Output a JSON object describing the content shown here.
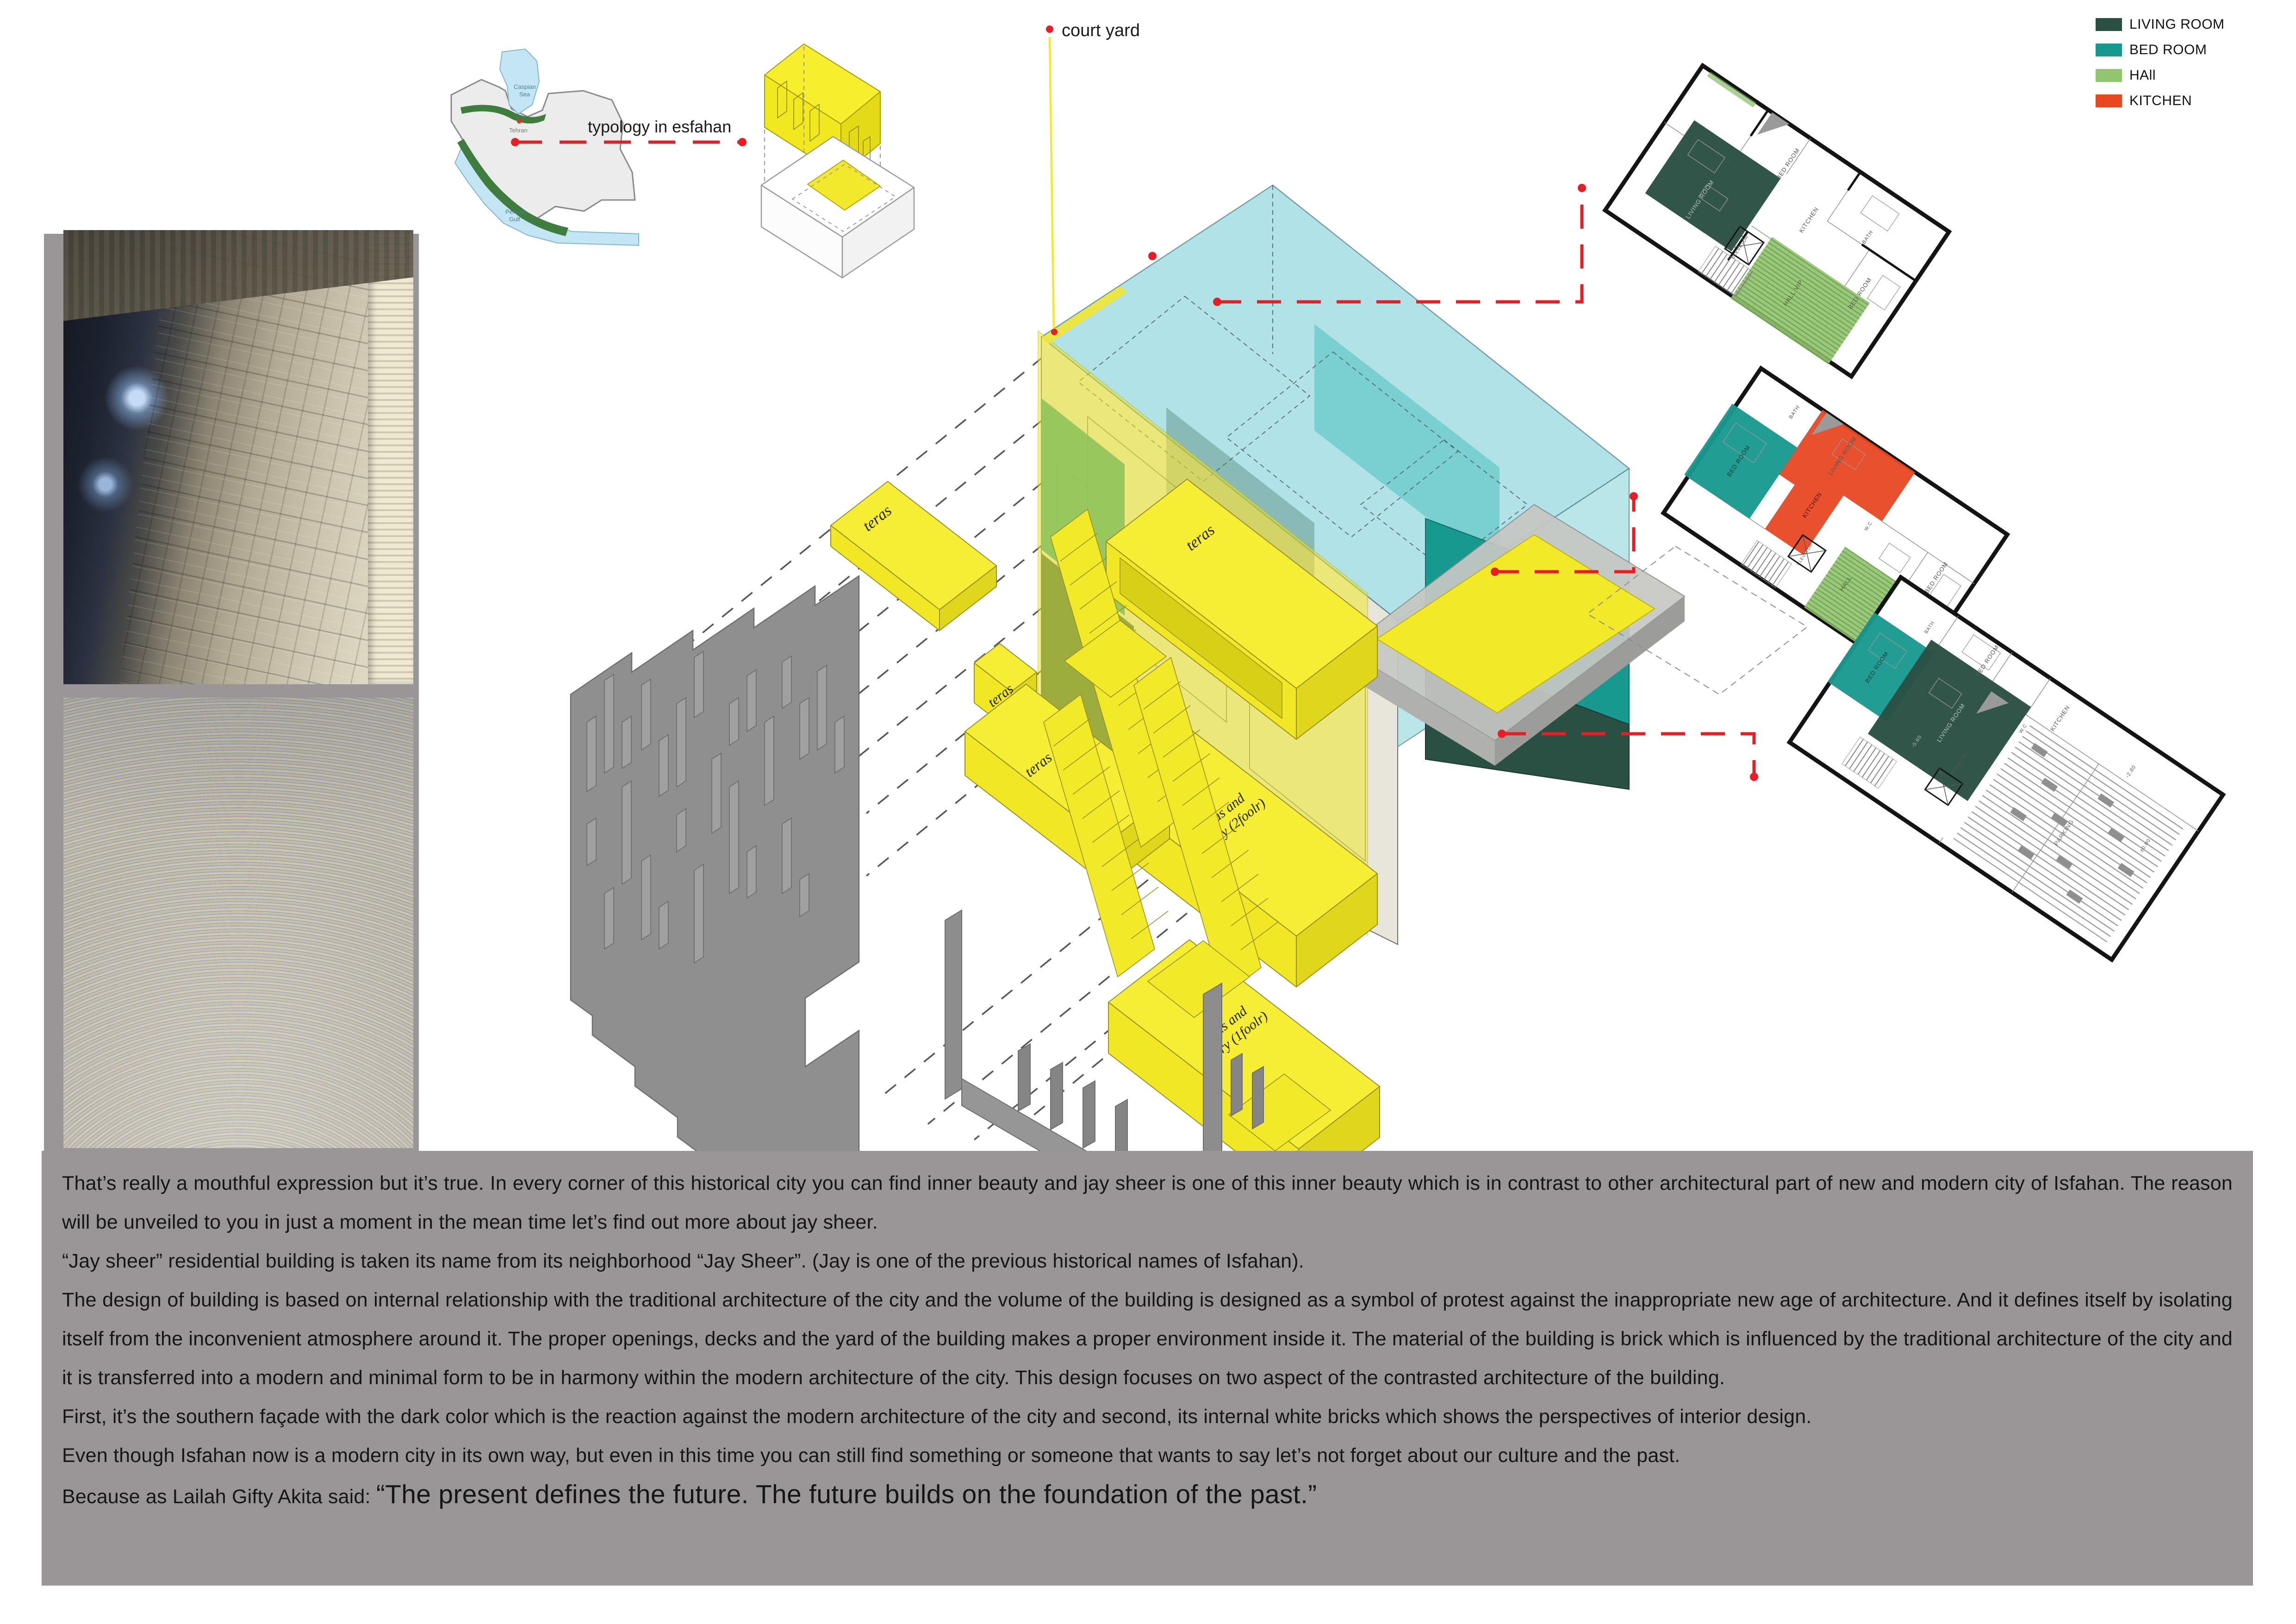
{
  "title_labels": {
    "courtyard": "court yard",
    "typology": "typology in esfahan"
  },
  "legend": {
    "items": [
      {
        "label": "LIVING ROOM",
        "color": "#2a4f43"
      },
      {
        "label": "BED ROOM",
        "color": "#18998f"
      },
      {
        "label": "HAll",
        "color": "#93c46e"
      },
      {
        "label": "KITCHEN",
        "color": "#e84722"
      }
    ]
  },
  "map": {
    "caspian_line1": "Caspian",
    "caspian_line2": "Sea",
    "tehran": "Tehran",
    "gulf_line1": "Persian",
    "gulf_line2": "Gulf"
  },
  "axon": {
    "teras_label": "teras",
    "entry2_line1": "teras and",
    "entry2_line2": "entry (2foolr)",
    "entry1_line1": "teras and",
    "entry1_line2": "entry (1foolr)"
  },
  "plans": {
    "p1": {
      "bed1": "BED ROOM",
      "kitchen": "KITCHEN",
      "living": "LIVING ROOM",
      "hall": "HALL VIP",
      "elevator": "ELEVATOR",
      "bath": "BATH",
      "bed2": "BED ROOM"
    },
    "p2": {
      "bath": "BATH",
      "living": "LIVING ROOM",
      "bed1": "BED ROOM",
      "kitchen": "KITCHEN",
      "wc": "W.C",
      "elevator": "ELEVATOR",
      "hall": "HALL",
      "bed2": "BED ROOM"
    },
    "p3": {
      "bed1": "BED ROOM",
      "bath": "BATH",
      "bed2": "BED ROOM",
      "living": "LIVING ROOM",
      "kitchen": "KITCHEN",
      "wc": "W.C",
      "elevator": "ELEVATOR",
      "parking": "PARKING",
      "lvl_a": "-2.80",
      "lvl_b": "±0.00",
      "lvl_c": "-0.60"
    }
  },
  "text_block": {
    "p1": "That’s really a mouthful expression but it’s true. In every corner of this historical city you can find inner beauty and jay sheer is one of this inner beauty which is in contrast to other architectural part of new and modern city of Isfahan. The reason will be unveiled to you in just a moment in the mean time let’s find out more about jay sheer.",
    "p2": "“Jay sheer” residential building is taken its name from its neighborhood “Jay Sheer”. (Jay is one of the previous historical names of Isfahan).",
    "p3": "The design of building is based on internal relationship with the traditional architecture of the city and the volume of the building is designed as a symbol of protest against the inappropriate new age of architecture. And it defines itself by isolating itself from the inconvenient atmosphere around it. The proper openings, decks and the yard of the building makes a proper environment inside it. The material of the building is brick which is influenced by the traditional architecture of the city and it is transferred into a modern and minimal form to be in harmony within the modern architecture of the city. This design focuses on two aspect of the contrasted architecture of the building.",
    "p4": "First, it’s the southern façade with the dark color which is the reaction against the modern architecture of the city and second, its internal white bricks which shows the perspectives of interior design.",
    "p5": "Even though Isfahan now is a modern city in its own way, but even in this time you can still find something or someone that wants to say let’s not forget about our culture and the past.",
    "quote_prefix": " Because as Lailah Gifty Akita said: ",
    "quote": "“The present defines the future. The future builds on the foundation of the past.”"
  },
  "colors": {
    "accent_red": "#ec1c24",
    "accent_yellow": "#f2e928",
    "cyan_volume": "#a7dde2",
    "teal": "#18998f",
    "dark_green": "#2a4f43",
    "hall_green": "#93c46e",
    "kitchen_red": "#e84722",
    "panel_gray": "#9a9697"
  }
}
